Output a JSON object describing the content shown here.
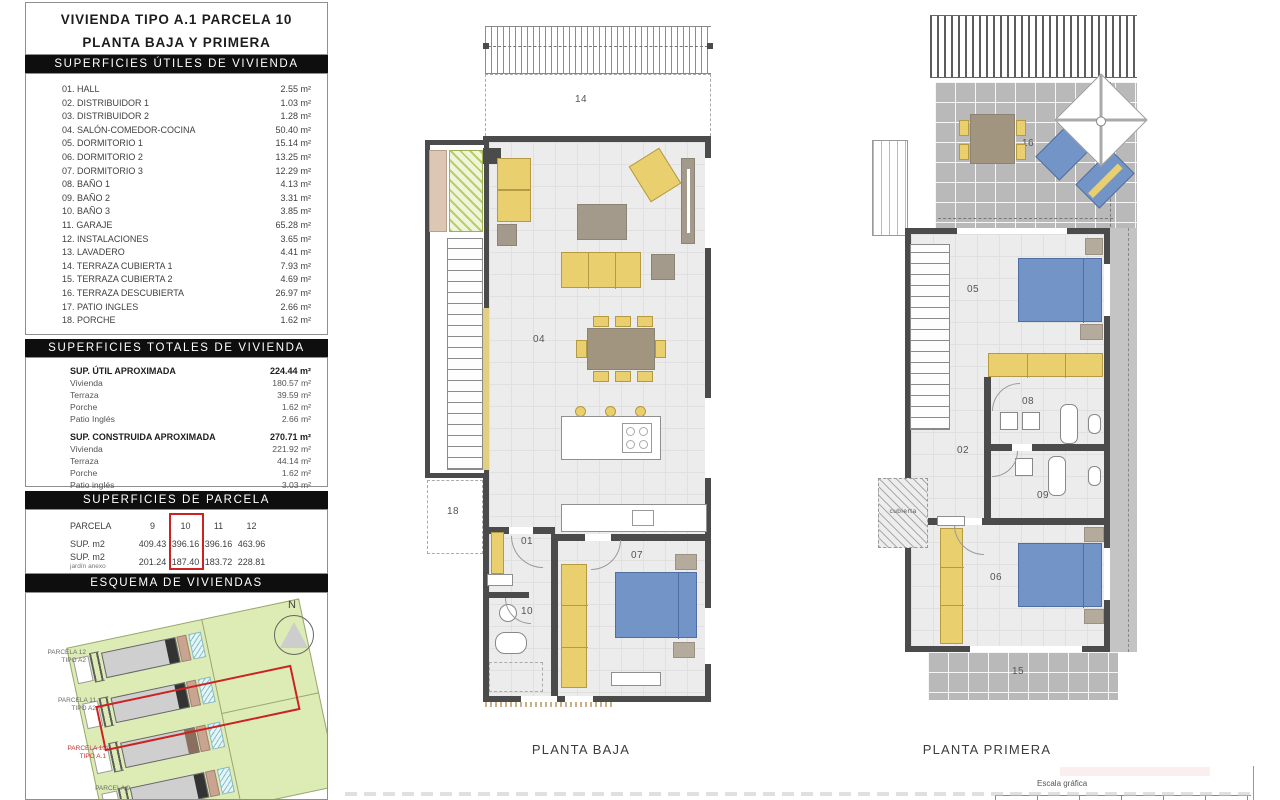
{
  "left_panel": {
    "title_line1": "VIVIENDA TIPO A.1 PARCELA 10",
    "title_line2": "PLANTA BAJA Y PRIMERA",
    "utiles": {
      "header": "SUPERFICIES ÚTILES DE VIVIENDA",
      "rows": [
        {
          "label": "01. HALL",
          "value": "2.55 m²"
        },
        {
          "label": "02. DISTRIBUIDOR 1",
          "value": "1.03 m²"
        },
        {
          "label": "03. DISTRIBUIDOR 2",
          "value": "1.28 m²"
        },
        {
          "label": "04. SALÓN-COMEDOR-COCINA",
          "value": "50.40 m²"
        },
        {
          "label": "05. DORMITORIO 1",
          "value": "15.14 m²"
        },
        {
          "label": "06. DORMITORIO 2",
          "value": "13.25 m²"
        },
        {
          "label": "07. DORMITORIO 3",
          "value": "12.29 m²"
        },
        {
          "label": "08. BAÑO 1",
          "value": "4.13 m²"
        },
        {
          "label": "09. BAÑO 2",
          "value": "3.31 m²"
        },
        {
          "label": "10. BAÑO 3",
          "value": "3.85 m²"
        },
        {
          "label": "11. GARAJE",
          "value": "65.28 m²"
        },
        {
          "label": "12. INSTALACIONES",
          "value": "3.65 m²"
        },
        {
          "label": "13. LAVADERO",
          "value": "4.41 m²"
        },
        {
          "label": "14. TERRAZA CUBIERTA 1",
          "value": "7.93 m²"
        },
        {
          "label": "15. TERRAZA CUBIERTA 2",
          "value": "4.69 m²"
        },
        {
          "label": "16. TERRAZA DESCUBIERTA",
          "value": "26.97 m²"
        },
        {
          "label": "17. PATIO INGLES",
          "value": "2.66 m²"
        },
        {
          "label": "18. PORCHE",
          "value": "1.62 m²"
        }
      ]
    },
    "totales": {
      "header": "SUPERFICIES TOTALES DE VIVIENDA",
      "groups": [
        {
          "title": "SUP. ÚTIL APROXIMADA",
          "total": "224.44 m²",
          "rows": [
            {
              "label": "Vivienda",
              "value": "180.57 m²"
            },
            {
              "label": "Terraza",
              "value": "39.59 m²"
            },
            {
              "label": "Porche",
              "value": "1.62 m²"
            },
            {
              "label": "Patio Inglés",
              "value": "2.66 m²"
            }
          ]
        },
        {
          "title": "SUP. CONSTRUIDA APROXIMADA",
          "total": "270.71 m²",
          "rows": [
            {
              "label": "Vivienda",
              "value": "221.92 m²"
            },
            {
              "label": "Terraza",
              "value": "44.14 m²"
            },
            {
              "label": "Porche",
              "value": "1.62 m²"
            },
            {
              "label": "Patio inglés",
              "value": "3.03 m²"
            }
          ]
        }
      ]
    },
    "parcela": {
      "header": "SUPERFICIES DE PARCELA",
      "col_label": "PARCELA",
      "cols": [
        "9",
        "10",
        "11",
        "12"
      ],
      "row1_label": "SUP. m2",
      "row1": [
        "409.43",
        "396.16",
        "396.16",
        "463.96"
      ],
      "row2_label": "SUP. m2",
      "row2_sublabel": "jardín anexo",
      "row2": [
        "201.24",
        "187.40",
        "183.72",
        "228.81"
      ],
      "highlight_col": "10",
      "highlight_color": "#cc2222"
    },
    "esquema": {
      "header": "ESQUEMA DE VIVIENDAS",
      "north_label": "N",
      "labels": [
        {
          "line1": "PARCELA 12",
          "line2": "TIPO A2"
        },
        {
          "line1": "PARCELA 11",
          "line2": "TIPO A2"
        },
        {
          "line1": "PARCELA 10",
          "line2": "TIPO A.1"
        },
        {
          "line1": "PARCELA 9",
          "line2": ""
        }
      ],
      "highlight_parcel": "PARCELA 10 TIPO A.1"
    }
  },
  "plans": {
    "baja": {
      "caption": "PLANTA BAJA",
      "rooms": [
        "14",
        "04",
        "18",
        "01",
        "10",
        "07"
      ]
    },
    "primera": {
      "caption": "PLANTA PRIMERA",
      "rooms": [
        "16",
        "05",
        "08",
        "02",
        "09",
        "cubierta",
        "06",
        "15"
      ]
    }
  },
  "footer": {
    "escala_label": "Escala gráfica"
  },
  "colors": {
    "wall": "#4b4b4b",
    "furniture_yellow": "#e9cf6d",
    "furniture_gray": "#a39a8b",
    "bed_blue": "#7294c7",
    "terrace_gray": "#b9b9b9",
    "site_green": "#dcecb4",
    "highlight_red": "#cc2222"
  }
}
